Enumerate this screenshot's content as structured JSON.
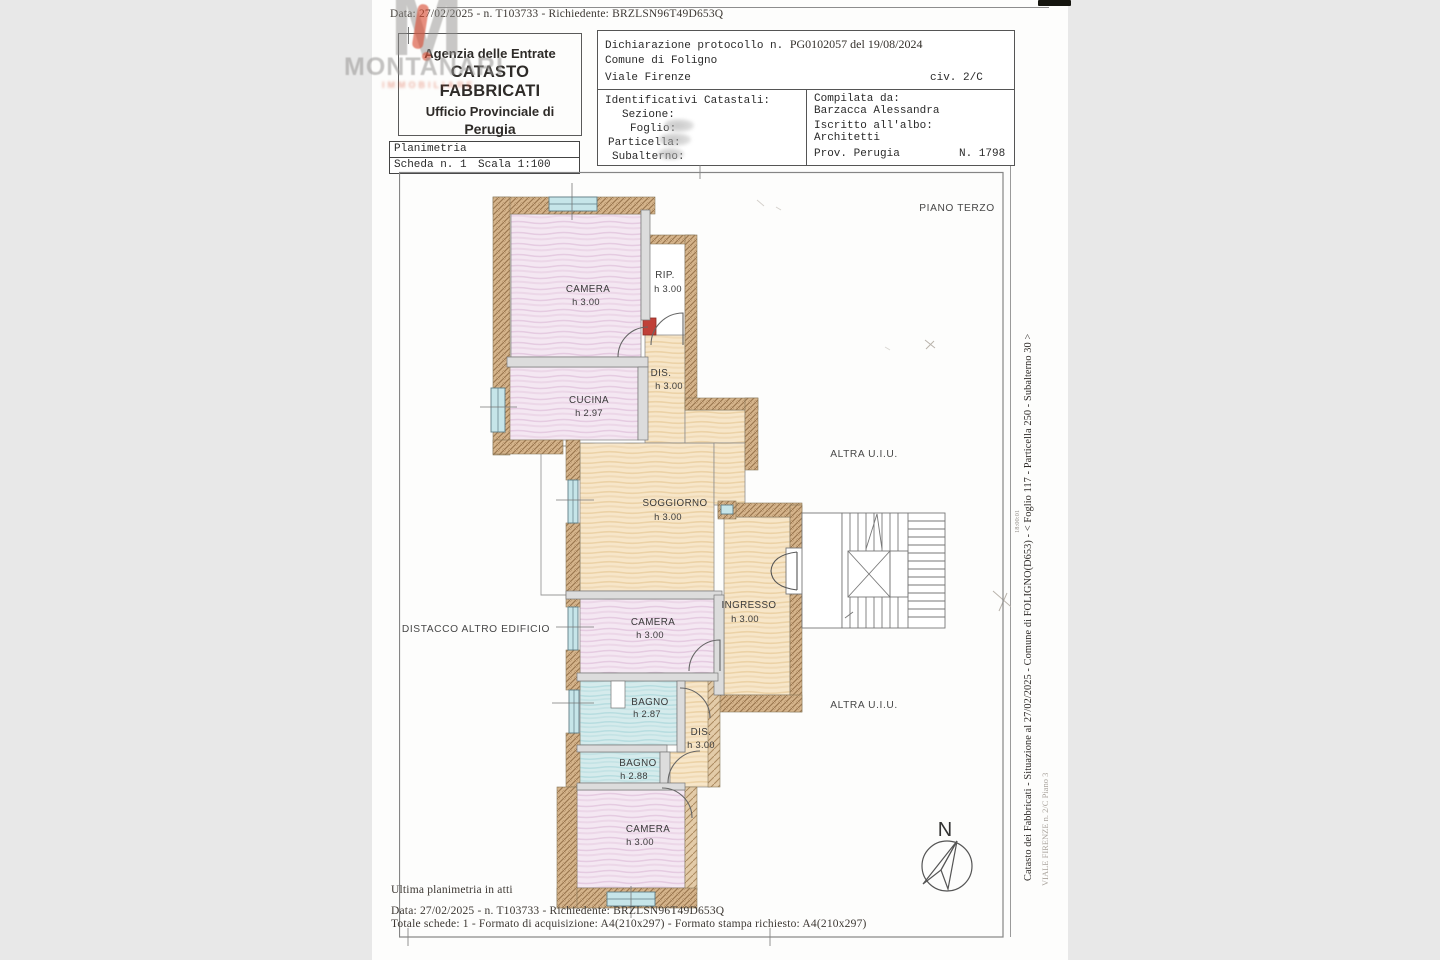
{
  "colors": {
    "wall_hatch": "#cfa878",
    "room_pink": "#f4e7f2",
    "room_tan": "#f7e6c9",
    "room_cyan": "#d3eaec",
    "red_wall_mark": "#c04038",
    "watermark_red": "#d84a30",
    "watermark_gray": "#969290"
  },
  "top_line": "Data: 27/02/2025 - n. T103733 - Richiedente: BRZLSN96T49D653Q",
  "agency": {
    "line1": "Agenzia delle Entrate",
    "line2": "CATASTO FABBRICATI",
    "line3": "Ufficio Provinciale di",
    "line4": "Perugia"
  },
  "plan_title": {
    "title": "Planimetria",
    "scheda": "Scheda n. 1",
    "scala": "Scala 1:100"
  },
  "declaration": {
    "protocol_label": "Dichiarazione protocollo n.",
    "protocol_value": "PG0102057 del  19/08/2024",
    "comune": "Comune di Foligno",
    "via": "Viale Firenze",
    "civ": "civ. 2/C",
    "ident_title": "Identificativi Catastali:",
    "field_sezione": "Sezione:",
    "field_foglio": "Foglio:",
    "field_particella": "Particella:",
    "field_subalterno": "Subalterno:",
    "compilata_label": "Compilata da:",
    "compilata_name": "Barzacca Alessandra",
    "albo_label": "Iscritto all'albo:",
    "albo_value": "Architetti",
    "prov": "Prov. Perugia",
    "num": "N. 1798"
  },
  "plan": {
    "floor_label": "PIANO TERZO",
    "altra_uiu_1": "ALTRA U.I.U.",
    "altra_uiu_2": "ALTRA U.I.U.",
    "distacco": "DISTACCO ALTRO EDIFICIO",
    "compass_n": "N",
    "rooms": [
      {
        "label": "CAMERA",
        "height": "h 3.00"
      },
      {
        "label": "RIP.",
        "height": "h 3.00"
      },
      {
        "label": "DIS.",
        "height": "h 3.00"
      },
      {
        "label": "CUCINA",
        "height": "h 2.97"
      },
      {
        "label": "SOGGIORNO",
        "height": "h 3.00"
      },
      {
        "label": "INGRESSO",
        "height": "h 3.00"
      },
      {
        "label": "CAMERA",
        "height": "h 3.00"
      },
      {
        "label": "BAGNO",
        "height": "h 2.87"
      },
      {
        "label": "DIS.",
        "height": "h 3.00"
      },
      {
        "label": "BAGNO",
        "height": "h 2.88"
      },
      {
        "label": "CAMERA",
        "height": "h 3.00"
      }
    ]
  },
  "side": {
    "line1": "Catasto dei Fabbricati - Situazione al 27/02/2025 - Comune di FOLIGNO(D653) - <  Foglio 117 - Particella  250 - Subalterno 30 >",
    "line2": "VIALE FIRENZE n. 2/C Piano 3",
    "stamp": "18:00:01"
  },
  "bottom": {
    "ultima": "Ultima planimetria in atti",
    "data_line": "Data: 27/02/2025 - n. T103733 - Richiedente: BRZLSN96T49D653Q",
    "totale": "Totale schede: 1 - Formato di acquisizione: A4(210x297)  - Formato stampa richiesto: A4(210x297)"
  },
  "watermark": {
    "letter": "M",
    "name": "MONTANARI",
    "sub": "IMMOBILIARE"
  }
}
